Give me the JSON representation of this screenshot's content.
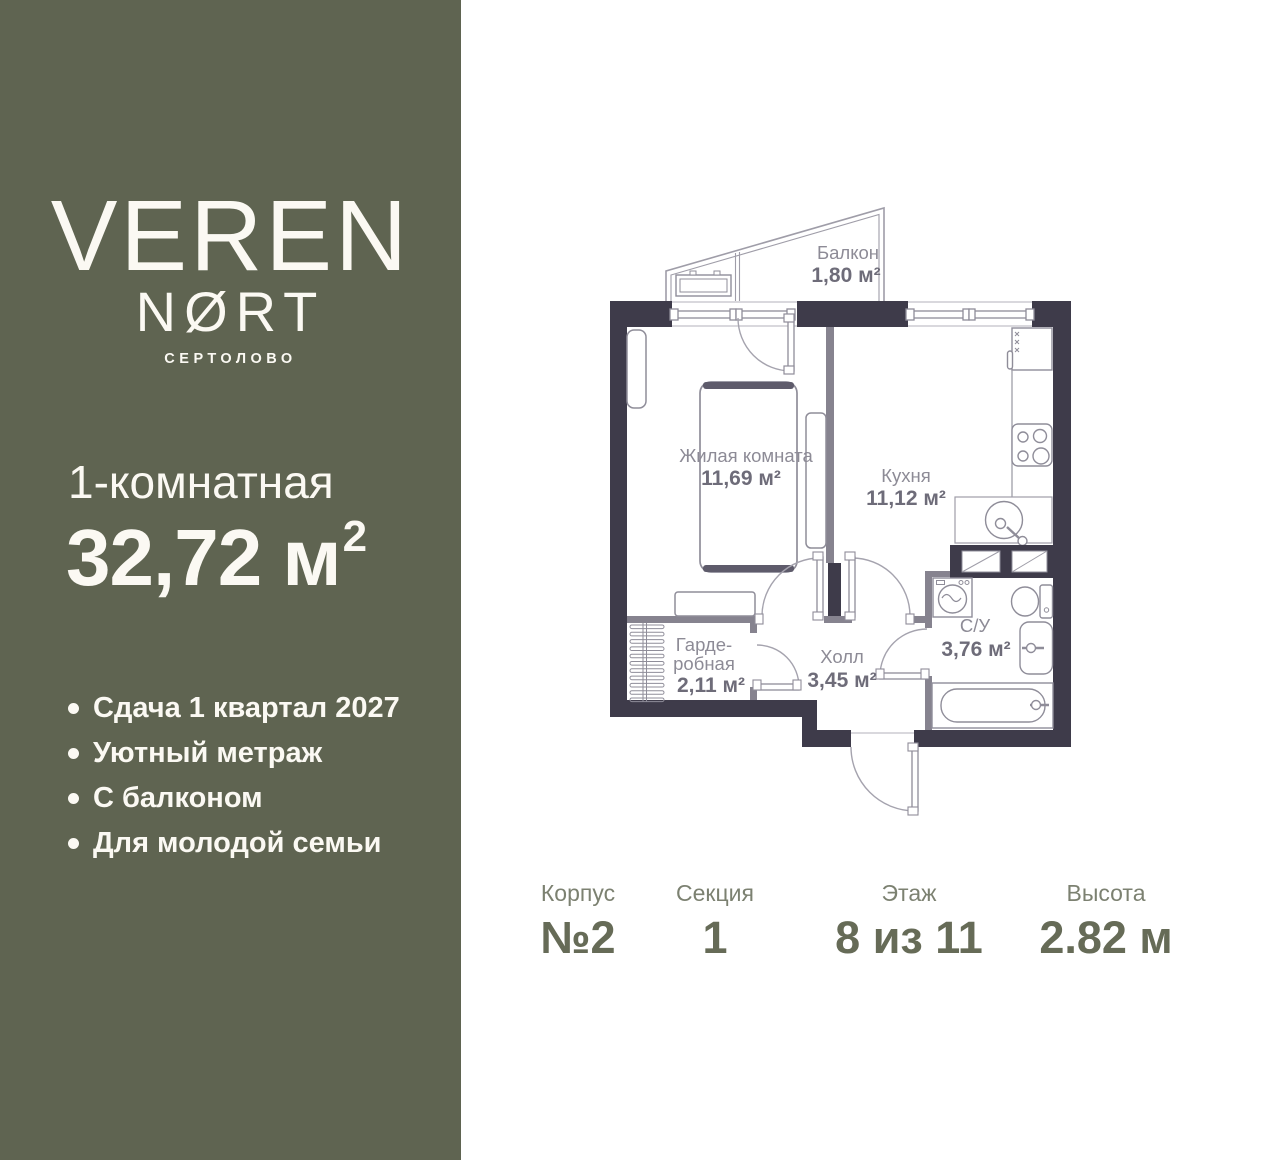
{
  "sidebar": {
    "logo_line1": "VEREN",
    "logo_line2": "NØRT",
    "logo_subtitle": "СЕРТОЛОВО",
    "apartment_type": "1-комнатная",
    "area_main": "32,72 м",
    "area_sup": "2",
    "features": [
      "Сдача 1 квартал 2027",
      "Уютный метраж",
      "С балконом",
      "Для молодой семьи"
    ],
    "colors": {
      "background": "#5f6451",
      "text": "#fbf9f3"
    }
  },
  "floorplan": {
    "labels": {
      "balcony_name": "Балкон",
      "balcony_area": "1,80 м²",
      "living_name": "Жилая комната",
      "living_area": "11,69 м²",
      "kitchen_name": "Кухня",
      "kitchen_area": "11,12 м²",
      "wardrobe_name_line1": "Гарде-",
      "wardrobe_name_line2": "робная",
      "wardrobe_area": "2,11 м²",
      "hall_name": "Холл",
      "hall_area": "3,45 м²",
      "bathroom_name": "С/У",
      "bathroom_area": "3,76 м²"
    },
    "colors": {
      "wall": "#3e3b4a",
      "partition": "#86838f",
      "outline": "#9f9da8",
      "furniture_stroke": "#8f8d99",
      "label_text": "#8d8b96",
      "area_text": "#6e6c79"
    }
  },
  "details": {
    "items": [
      {
        "label": "Корпус",
        "value": "№2"
      },
      {
        "label": "Секция",
        "value": "1"
      },
      {
        "label": "Этаж",
        "value": "8 из 11"
      },
      {
        "label": "Высота",
        "value": "2.82 м"
      }
    ],
    "colors": {
      "label": "#7c8171",
      "value": "#666b57"
    }
  }
}
